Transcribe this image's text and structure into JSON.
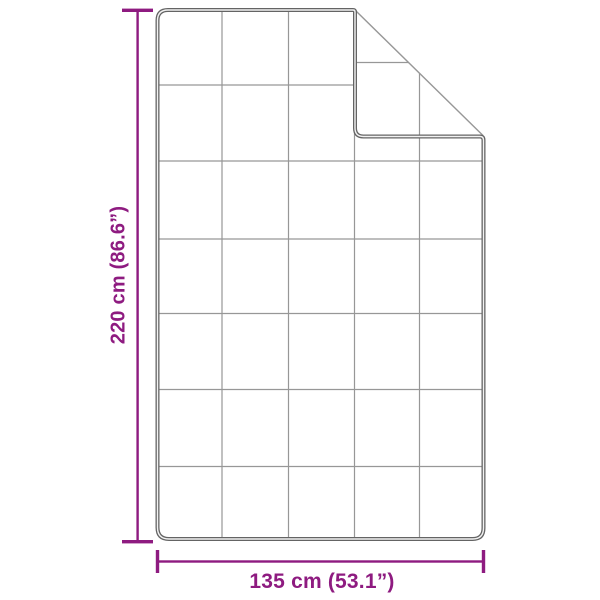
{
  "diagram": {
    "type": "product-dimension-diagram",
    "subject": "blanket with quilted square grid pattern and folded-over top-right corner",
    "dimensions": {
      "height_label": "220 cm (86.6”)",
      "width_label": "135 cm (53.1”)"
    },
    "colors": {
      "dimension_accent": "#8E1B80",
      "outline": "#646464",
      "outline_highlight": "#f2f2f2",
      "grid_line": "#979797",
      "background": "#ffffff"
    }
  }
}
